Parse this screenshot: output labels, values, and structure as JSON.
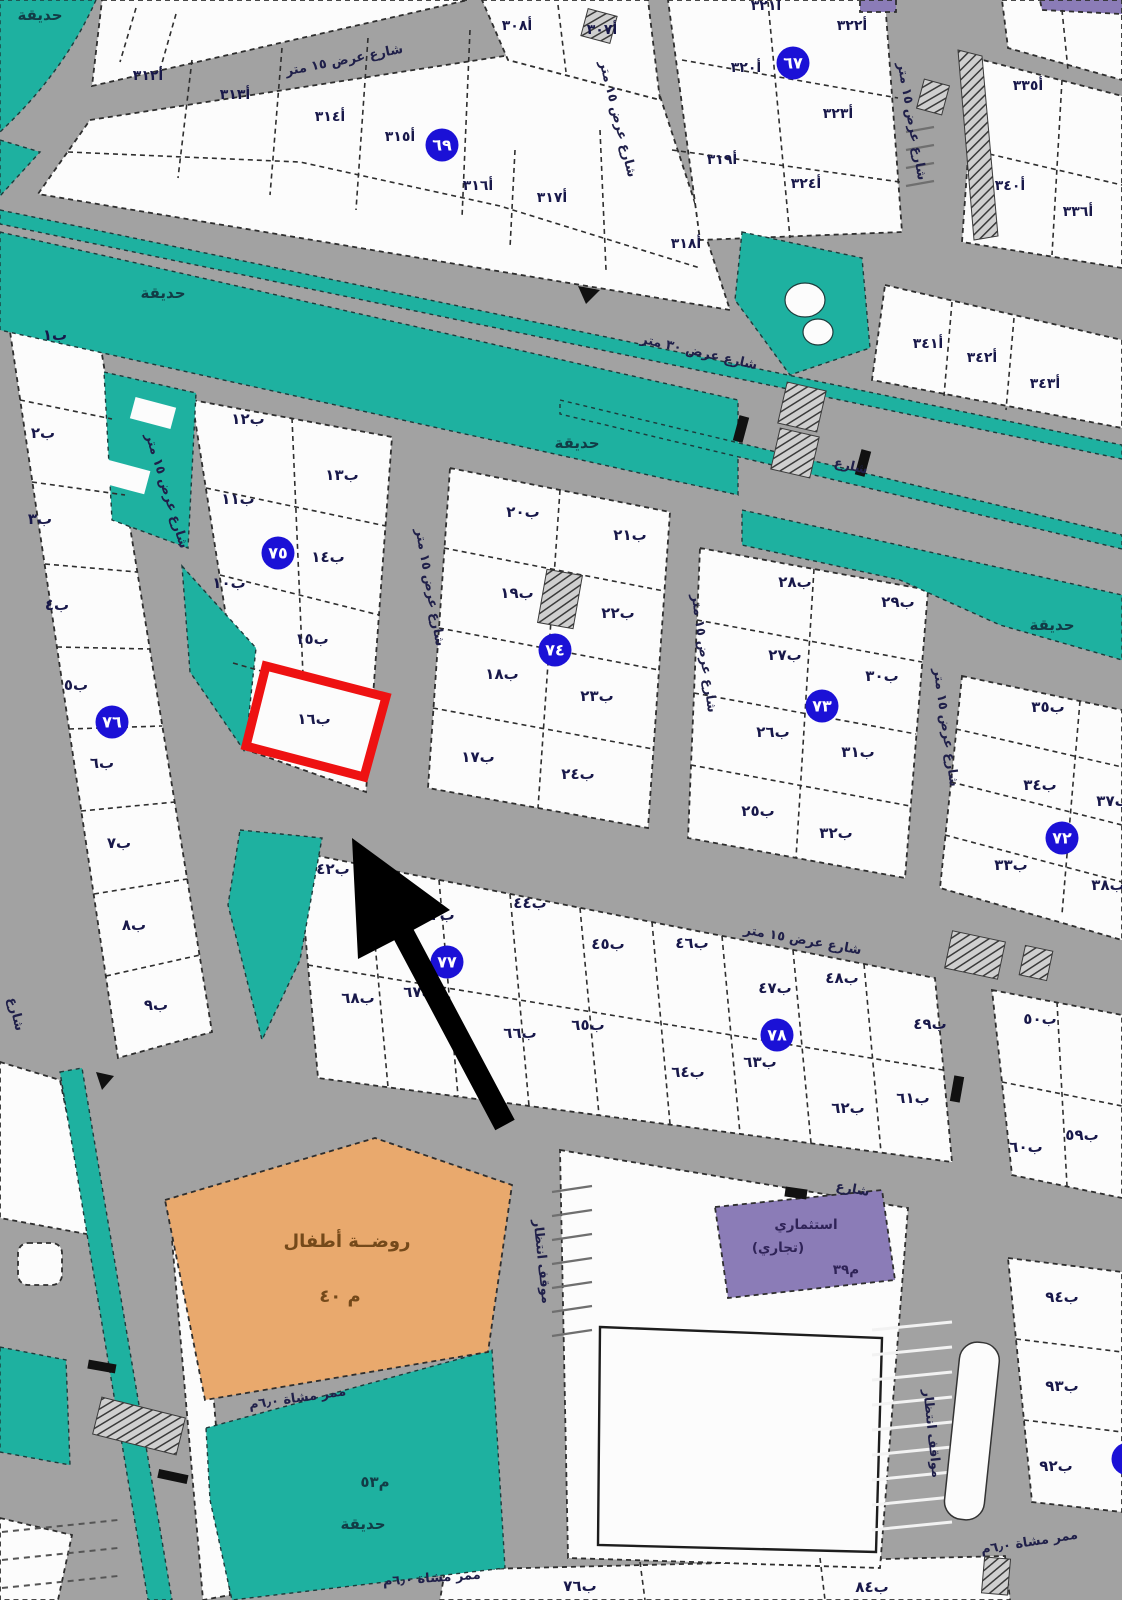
{
  "map": {
    "colors": {
      "road": "#a2a2a2",
      "plot_fill": "#fcfcfc",
      "park_teal": "#1eb1a0",
      "kindergarten_orange": "#e9a96d",
      "commercial_purple": "#8b7cb7",
      "badge_blue": "#1b11d6",
      "highlight_red": "#ee1212",
      "arrow_black": "#000000"
    },
    "highlighted_plot": {
      "label": "ب١٦",
      "note": "red-outlined plot with black arrow pointing to it"
    },
    "badges": [
      {
        "text": "٦٧",
        "x": 793,
        "y": 63
      },
      {
        "text": "٦٩",
        "x": 442,
        "y": 145
      },
      {
        "text": "٧٥",
        "x": 278,
        "y": 553
      },
      {
        "text": "٧٤",
        "x": 555,
        "y": 650
      },
      {
        "text": "٧٣",
        "x": 822,
        "y": 706
      },
      {
        "text": "٧٦",
        "x": 112,
        "y": 722
      },
      {
        "text": "٧٢",
        "x": 1062,
        "y": 838
      },
      {
        "text": "٧٧",
        "x": 447,
        "y": 962
      },
      {
        "text": "٧٨",
        "x": 777,
        "y": 1035
      },
      {
        "text": "",
        "x": 1128,
        "y": 1459
      }
    ],
    "plots_top": [
      {
        "text": "أ٣١٢",
        "x": 148,
        "y": 80
      },
      {
        "text": "أ٣١٣",
        "x": 235,
        "y": 99
      },
      {
        "text": "أ٣١٤",
        "x": 330,
        "y": 121
      },
      {
        "text": "أ٣١٥",
        "x": 400,
        "y": 141
      },
      {
        "text": "أ٣١٦",
        "x": 478,
        "y": 190
      },
      {
        "text": "أ٣١٧",
        "x": 552,
        "y": 202
      },
      {
        "text": "أ٣١٨",
        "x": 686,
        "y": 248
      },
      {
        "text": "أ٣٠٨",
        "x": 517,
        "y": 30
      },
      {
        "text": "أ٣٠٧",
        "x": 602,
        "y": 34
      },
      {
        "text": "أ٣٢١",
        "x": 766,
        "y": 10
      },
      {
        "text": "أ٣٢٢",
        "x": 852,
        "y": 30
      },
      {
        "text": "أ٣٢٠",
        "x": 746,
        "y": 72
      },
      {
        "text": "أ٣٢٣",
        "x": 838,
        "y": 118
      },
      {
        "text": "أ٣١٩",
        "x": 722,
        "y": 164
      },
      {
        "text": "أ٣٢٤",
        "x": 806,
        "y": 188
      },
      {
        "text": "أ٣٣٥",
        "x": 1028,
        "y": 90
      },
      {
        "text": "أ٣٤٠",
        "x": 1010,
        "y": 190
      },
      {
        "text": "أ٣٣٦",
        "x": 1078,
        "y": 216
      },
      {
        "text": "أ٣٤١",
        "x": 928,
        "y": 348
      },
      {
        "text": "أ٣٤٢",
        "x": 982,
        "y": 362
      },
      {
        "text": "أ٣٤٣",
        "x": 1045,
        "y": 388
      }
    ],
    "plots_lower": [
      {
        "text": "ب١",
        "x": 55,
        "y": 340
      },
      {
        "text": "ب٢",
        "x": 43,
        "y": 438
      },
      {
        "text": "ب٣",
        "x": 40,
        "y": 524
      },
      {
        "text": "ب٤",
        "x": 57,
        "y": 610
      },
      {
        "text": "ب٥",
        "x": 76,
        "y": 690
      },
      {
        "text": "ب٦",
        "x": 102,
        "y": 768
      },
      {
        "text": "ب٧",
        "x": 119,
        "y": 848
      },
      {
        "text": "ب٨",
        "x": 134,
        "y": 930
      },
      {
        "text": "ب٩",
        "x": 156,
        "y": 1010
      },
      {
        "text": "ب١٢",
        "x": 248,
        "y": 424
      },
      {
        "text": "ب١٣",
        "x": 342,
        "y": 480
      },
      {
        "text": "ب١١",
        "x": 238,
        "y": 504
      },
      {
        "text": "ب١٤",
        "x": 328,
        "y": 562
      },
      {
        "text": "ب١٠",
        "x": 229,
        "y": 588
      },
      {
        "text": "ب١٥",
        "x": 312,
        "y": 644
      },
      {
        "text": "ب١٦",
        "x": 314,
        "y": 724
      },
      {
        "text": "ب٢٠",
        "x": 523,
        "y": 517
      },
      {
        "text": "ب٢١",
        "x": 630,
        "y": 540
      },
      {
        "text": "ب١٩",
        "x": 517,
        "y": 598
      },
      {
        "text": "ب٢٢",
        "x": 618,
        "y": 618
      },
      {
        "text": "ب١٨",
        "x": 502,
        "y": 679
      },
      {
        "text": "ب٢٣",
        "x": 597,
        "y": 701
      },
      {
        "text": "ب١٧",
        "x": 478,
        "y": 762
      },
      {
        "text": "ب٢٤",
        "x": 578,
        "y": 779
      },
      {
        "text": "ب٢٨",
        "x": 795,
        "y": 587
      },
      {
        "text": "ب٢٩",
        "x": 898,
        "y": 607
      },
      {
        "text": "ب٢٧",
        "x": 785,
        "y": 660
      },
      {
        "text": "ب٣٠",
        "x": 882,
        "y": 681
      },
      {
        "text": "ب٢٦",
        "x": 773,
        "y": 737
      },
      {
        "text": "ب٣١",
        "x": 858,
        "y": 757
      },
      {
        "text": "ب٢٥",
        "x": 758,
        "y": 816
      },
      {
        "text": "ب٣٢",
        "x": 836,
        "y": 838
      },
      {
        "text": "ب٣٥",
        "x": 1048,
        "y": 712
      },
      {
        "text": "ب٣٤",
        "x": 1040,
        "y": 790
      },
      {
        "text": "ب٣٧",
        "x": 1113,
        "y": 806
      },
      {
        "text": "ب٣٣",
        "x": 1011,
        "y": 870
      },
      {
        "text": "ب٣٨",
        "x": 1108,
        "y": 890
      },
      {
        "text": "ب٤٢",
        "x": 333,
        "y": 874
      },
      {
        "text": "ب٤٣",
        "x": 438,
        "y": 920
      },
      {
        "text": "ب٤٤",
        "x": 530,
        "y": 908
      },
      {
        "text": "ب٤٥",
        "x": 608,
        "y": 949
      },
      {
        "text": "ب٤٦",
        "x": 692,
        "y": 948
      },
      {
        "text": "ب٤٧",
        "x": 775,
        "y": 993
      },
      {
        "text": "ب٤٨",
        "x": 842,
        "y": 983
      },
      {
        "text": "ب٤٩",
        "x": 930,
        "y": 1029
      },
      {
        "text": "ب٥٠",
        "x": 1040,
        "y": 1024
      },
      {
        "text": "ب٦٨",
        "x": 358,
        "y": 1003
      },
      {
        "text": "ب٦٧",
        "x": 420,
        "y": 997
      },
      {
        "text": "ب٦٦",
        "x": 520,
        "y": 1038
      },
      {
        "text": "ب٦٥",
        "x": 588,
        "y": 1030
      },
      {
        "text": "ب٦٤",
        "x": 688,
        "y": 1077
      },
      {
        "text": "ب٦٣",
        "x": 760,
        "y": 1067
      },
      {
        "text": "ب٦٢",
        "x": 848,
        "y": 1113
      },
      {
        "text": "ب٦١",
        "x": 913,
        "y": 1103
      },
      {
        "text": "ب٦٠",
        "x": 1026,
        "y": 1152
      },
      {
        "text": "ب٥٩",
        "x": 1082,
        "y": 1140
      },
      {
        "text": "ب٩٤",
        "x": 1062,
        "y": 1302
      },
      {
        "text": "ب٩٣",
        "x": 1062,
        "y": 1391
      },
      {
        "text": "ب٩٢",
        "x": 1056,
        "y": 1471
      },
      {
        "text": "ب٧٦",
        "x": 580,
        "y": 1591
      },
      {
        "text": "ب٨٤",
        "x": 872,
        "y": 1592
      }
    ],
    "street_labels": [
      {
        "text": "شارع عرض ١٥ متر",
        "x": 345,
        "y": 64,
        "rot": -11
      },
      {
        "text": "شارع عرض ١٥ متر",
        "x": 614,
        "y": 120,
        "rot": 76
      },
      {
        "text": "شارع عرض ١٥ متر",
        "x": 908,
        "y": 122,
        "rot": 80
      },
      {
        "text": "شارع عرض ٣٠ متر",
        "x": 698,
        "y": 356,
        "rot": 13
      },
      {
        "text": "شارع",
        "x": 850,
        "y": 470,
        "rot": 13
      },
      {
        "text": "شارع عرض ١٥ متر",
        "x": 163,
        "y": 492,
        "rot": 73
      },
      {
        "text": "شارع عرض ١٥ متر",
        "x": 426,
        "y": 588,
        "rot": 80
      },
      {
        "text": "شارع عرض ١٥ متر",
        "x": 700,
        "y": 654,
        "rot": 82
      },
      {
        "text": "شارع عرض ١٥ متر",
        "x": 942,
        "y": 728,
        "rot": 82
      },
      {
        "text": "شارع عرض ١٥ متر",
        "x": 802,
        "y": 944,
        "rot": 10
      },
      {
        "text": "شارع",
        "x": 852,
        "y": 1193,
        "rot": 10
      },
      {
        "text": "شارع",
        "x": 12,
        "y": 1015,
        "rot": 76
      },
      {
        "text": "ممر مشاة ٦٫٠م",
        "x": 298,
        "y": 1402,
        "rot": -8
      },
      {
        "text": "ممر مشاة ٦٫٠م",
        "x": 432,
        "y": 1582,
        "rot": -4
      },
      {
        "text": "ممر مشاة ٦٫٠م",
        "x": 1030,
        "y": 1546,
        "rot": -9
      },
      {
        "text": "مواقف انتظار",
        "x": 928,
        "y": 1434,
        "rot": 84
      },
      {
        "text": "موقف انتظار",
        "x": 538,
        "y": 1262,
        "rot": 84
      }
    ],
    "park_labels": [
      {
        "text": "حديقة",
        "x": 40,
        "y": 20
      },
      {
        "text": "حديقة",
        "x": 163,
        "y": 298
      },
      {
        "text": "حديقة",
        "x": 577,
        "y": 448
      },
      {
        "text": "حديقة",
        "x": 1052,
        "y": 630
      },
      {
        "text": "م٥٣",
        "x": 375,
        "y": 1487
      },
      {
        "text": "حديقة",
        "x": 363,
        "y": 1529
      }
    ],
    "area_labels": [
      {
        "text": "روضــة أطفال",
        "x": 347,
        "y": 1247,
        "role": "knd"
      },
      {
        "text": "م ٤٠",
        "x": 340,
        "y": 1302,
        "role": "knd"
      },
      {
        "text": "استثماري",
        "x": 806,
        "y": 1229,
        "role": "com"
      },
      {
        "text": "(تجاري)",
        "x": 778,
        "y": 1252,
        "role": "com"
      },
      {
        "text": "م٣٩",
        "x": 846,
        "y": 1274,
        "role": "com"
      }
    ]
  }
}
